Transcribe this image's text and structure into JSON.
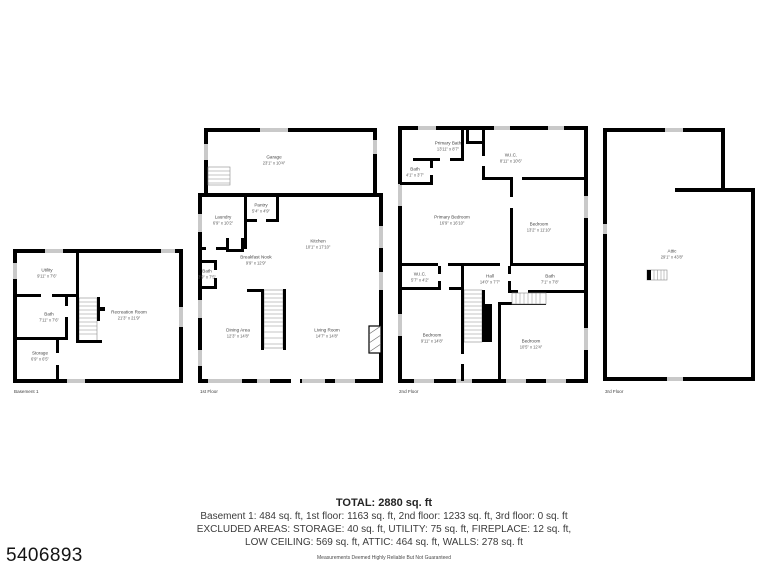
{
  "page": {
    "id_number": "5406893",
    "disclaimer": "Measurements Deemed Highly Reliable But Not Guaranteed"
  },
  "summary": {
    "total": "TOTAL: 2880 sq. ft",
    "floors_line": "Basement 1: 484 sq. ft, 1st floor: 1163 sq. ft, 2nd floor: 1233 sq. ft, 3rd floor: 0 sq. ft",
    "excluded_line1": "EXCLUDED AREAS: STORAGE: 40 sq. ft, UTILITY: 75 sq. ft, FIREPLACE: 12 sq. ft,",
    "excluded_line2": "LOW CEILING: 569 sq. ft, ATTIC: 464 sq. ft, WALLS: 278 sq. ft"
  },
  "colors": {
    "wall": "#000000",
    "window": "#c9c9c9",
    "text": "#474747"
  },
  "floors": {
    "basement": {
      "caption": "Basement 1",
      "rooms": {
        "utility": {
          "name": "Utility",
          "dims": "9'11\" x 7'6\""
        },
        "bath": {
          "name": "Bath",
          "dims": "7'11\" x 7'6\""
        },
        "recreation": {
          "name": "Recreation Room",
          "dims": "21'3\" x 21'9\""
        },
        "storage": {
          "name": "Storage",
          "dims": "6'9\" x 6'5\""
        }
      }
    },
    "first": {
      "caption": "1st Floor",
      "rooms": {
        "garage": {
          "name": "Garage",
          "dims": "23'1\" x 10'4\""
        },
        "pantry": {
          "name": "Pantry",
          "dims": "5'4\" x 4'9\""
        },
        "laundry": {
          "name": "Laundry",
          "dims": "6'9\" x 10'2\""
        },
        "kitchen": {
          "name": "Kitchen",
          "dims": "10'1\" x 17'10\""
        },
        "breakfast": {
          "name": "Breakfast Nook",
          "dims": "9'9\" x 12'9\""
        },
        "bath": {
          "name": "Bath",
          "dims": "3'9\" x 7'5\""
        },
        "dining": {
          "name": "Dining Area",
          "dims": "12'3\" x 14'8\""
        },
        "living": {
          "name": "Living Room",
          "dims": "14'7\" x 14'8\""
        }
      }
    },
    "second": {
      "caption": "2nd Floor",
      "rooms": {
        "primary_bath": {
          "name": "Primary Bath",
          "dims": "13'11\" x 8'7\""
        },
        "bath_small": {
          "name": "Bath",
          "dims": "4'1\" x 3'7\""
        },
        "wic_top": {
          "name": "W.I.C.",
          "dims": "8'11\" x 10'6\""
        },
        "primary_bedroom": {
          "name": "Primary Bedroom",
          "dims": "16'9\" x 16'10\""
        },
        "bedroom_right": {
          "name": "Bedroom",
          "dims": "13'2\" x 11'10\""
        },
        "wic_small": {
          "name": "W.I.C.",
          "dims": "5'7\" x 4'2\""
        },
        "hall": {
          "name": "Hall",
          "dims": "14'0\" x 7'7\""
        },
        "bath": {
          "name": "Bath",
          "dims": "7'1\" x 7'8\""
        },
        "bedroom_bl": {
          "name": "Bedroom",
          "dims": "9'11\" x 14'8\""
        },
        "bedroom_br": {
          "name": "Bedroom",
          "dims": "10'5\" x 12'4\""
        }
      }
    },
    "third": {
      "caption": "3rd Floor",
      "rooms": {
        "attic": {
          "name": "Attic",
          "dims": "29'1\" x 43'8\""
        }
      }
    }
  }
}
